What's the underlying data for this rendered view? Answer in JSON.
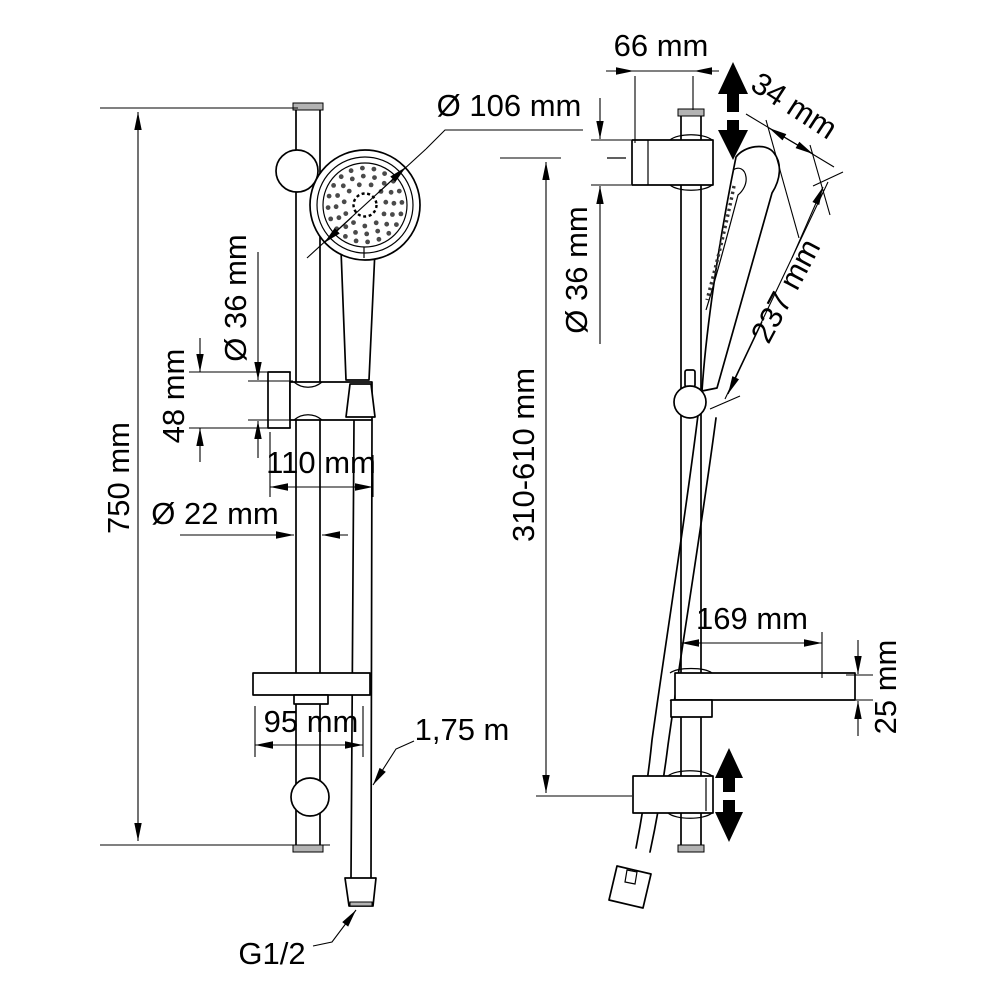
{
  "figure": {
    "type": "technical-drawing",
    "subject": "Shower rail set with hand shower, soap dish and wall hose connection — dimensioned front and side views"
  },
  "views": {
    "front": {
      "labels": {
        "total_height": "750 mm",
        "head_diameter": "Ø 106 mm",
        "holder_diameter": "Ø 36 mm",
        "holder_height": "48 mm",
        "holder_offset": "110 mm",
        "bar_diameter": "Ø 22 mm",
        "soap_dish_width": "95 mm",
        "hose_length": "1,75 m",
        "thread": "G1/2"
      }
    },
    "side": {
      "labels": {
        "wall_offset": "66 mm",
        "head_width": "34 mm",
        "handle_length": "237 mm",
        "bracket_diameter": "Ø 36 mm",
        "adjustable_range": "310-610 mm",
        "dish_depth": "169 mm",
        "dish_height": "25 mm"
      }
    }
  },
  "colors": {
    "line": "#000000",
    "background": "#ffffff",
    "cap_fill": "#b3b3b3",
    "arrow_fill": "#000000"
  }
}
